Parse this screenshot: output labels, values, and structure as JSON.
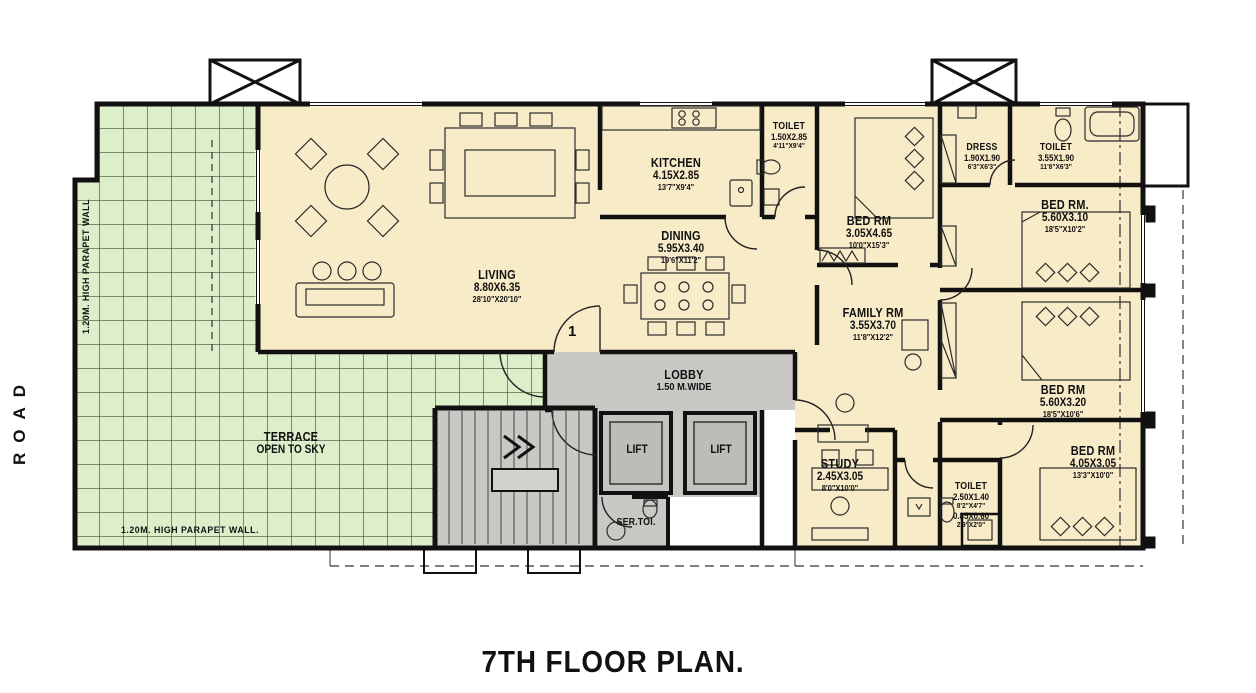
{
  "title": "7TH FLOOR  PLAN.",
  "annotations": {
    "road": "ROAD",
    "parapet_left": "1.20M. HIGH PARAPET WALL",
    "parapet_bottom": "1.20M. HIGH PARAPET WALL.",
    "entrance_marker": "1"
  },
  "terrace": {
    "name": "TERRACE",
    "note": "OPEN TO SKY"
  },
  "lobby": {
    "name": "LOBBY",
    "width": "1.50  M.WIDE"
  },
  "lifts": {
    "left": "LIFT",
    "right": "LIFT"
  },
  "service_toilet": "SER.TOI.",
  "rooms": [
    {
      "id": "kitchen",
      "name": "KITCHEN",
      "dim_m": "4.15X2.85",
      "dim_ft": "13'7\"X9'4\""
    },
    {
      "id": "toilet-kitchen",
      "name": "TOILET",
      "dim_m": "1.50X2.85",
      "dim_ft": "4'11\"X9'4\""
    },
    {
      "id": "dining",
      "name": "DINING",
      "dim_m": "5.95X3.40",
      "dim_ft": "19'6\"X11'2\""
    },
    {
      "id": "living",
      "name": "LIVING",
      "dim_m": "8.80X6.35",
      "dim_ft": "28'10\"X20'10\""
    },
    {
      "id": "bed-center",
      "name": "BED RM",
      "dim_m": "3.05X4.65",
      "dim_ft": "10'0\"X15'3\""
    },
    {
      "id": "dress",
      "name": "DRESS",
      "dim_m": "1.90X1.90",
      "dim_ft": "6'3\"X6'3\""
    },
    {
      "id": "toilet-top",
      "name": "TOILET",
      "dim_m": "3.55X1.90",
      "dim_ft": "11'8\"X6'3\""
    },
    {
      "id": "bed-top-right",
      "name": "BED RM.",
      "dim_m": "5.60X3.10",
      "dim_ft": "18'5\"X10'2\""
    },
    {
      "id": "family",
      "name": "FAMILY RM",
      "dim_m": "3.55X3.70",
      "dim_ft": "11'8\"X12'2\""
    },
    {
      "id": "bed-mid-right",
      "name": "BED RM",
      "dim_m": "5.60X3.20",
      "dim_ft": "18'5\"X10'6\""
    },
    {
      "id": "bed-bottom-right",
      "name": "BED RM",
      "dim_m": "4.05X3.05",
      "dim_ft": "13'3\"X10'0\""
    },
    {
      "id": "study",
      "name": "STUDY",
      "dim_m": "2.45X3.05",
      "dim_ft": "8'0\"X10'0\""
    },
    {
      "id": "toilet-bottom",
      "name": "TOILET",
      "dim_m": "2.50X1.40",
      "dim_ft": "8'2\"X4'7\"",
      "dim2_m": "0.85X0.60",
      "dim2_ft": "2'9\"X2'0\""
    }
  ],
  "colors": {
    "room_fill": "#f8ebc8",
    "terrace_fill": "#ddeeca",
    "circulation_fill": "#c9c8c5",
    "wall": "#111111"
  }
}
